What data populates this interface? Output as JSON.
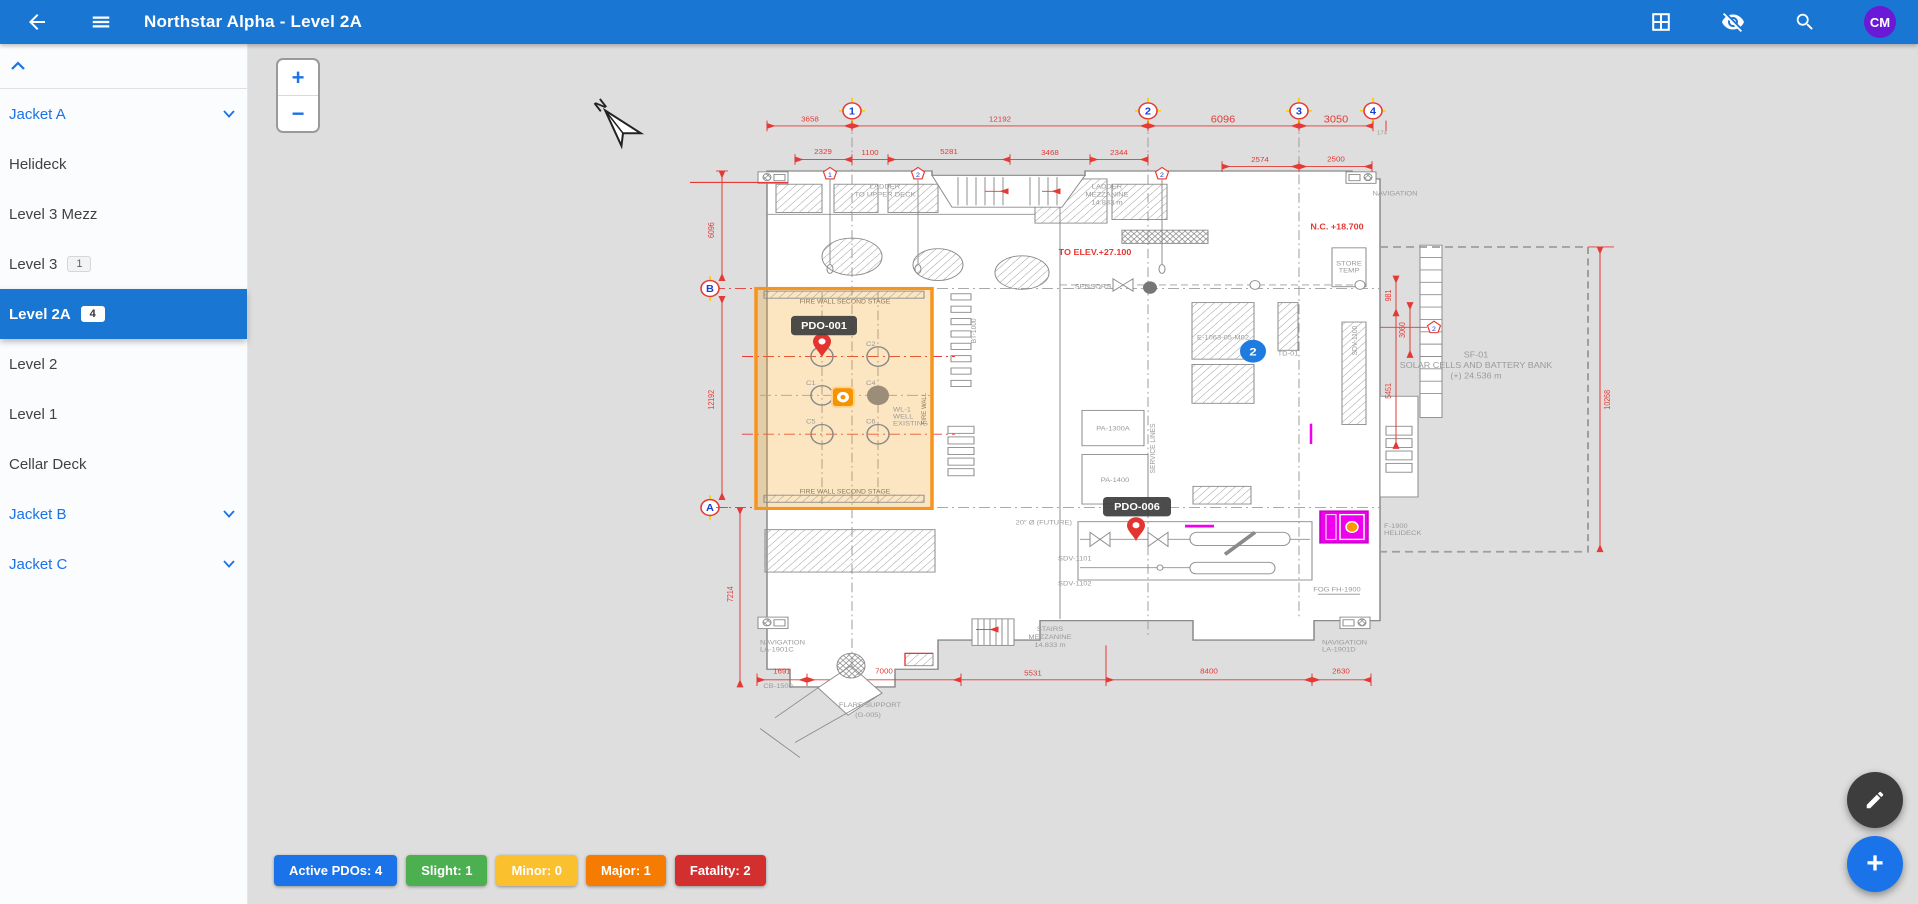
{
  "app_bar": {
    "title": "Northstar Alpha - Level 2A",
    "avatar_initials": "CM"
  },
  "sidebar": {
    "items": [
      {
        "label": "Jacket A",
        "type": "group",
        "expanded": true
      },
      {
        "label": "Helideck"
      },
      {
        "label": "Level 3 Mezz"
      },
      {
        "label": "Level 3",
        "badge": "1"
      },
      {
        "label": "Level 2A",
        "badge": "4",
        "selected": true
      },
      {
        "label": "Level 2"
      },
      {
        "label": "Level 1"
      },
      {
        "label": "Cellar Deck"
      },
      {
        "label": "Jacket B",
        "type": "group",
        "expanded": false
      },
      {
        "label": "Jacket C",
        "type": "group",
        "expanded": false
      }
    ]
  },
  "canvas": {
    "zoom_in": "+",
    "zoom_out": "−",
    "north": "N"
  },
  "markers": {
    "pdo_a": "PDO-001",
    "pdo_b": "PDO-006",
    "cluster_count": "2"
  },
  "plan": {
    "grid_cols": [
      "1",
      "2",
      "3",
      "4"
    ],
    "grid_rows": [
      "B",
      "A"
    ],
    "flags": [
      "1",
      "2",
      "2",
      "2"
    ],
    "dims": {
      "top1": [
        "3658",
        "12192",
        "6096",
        "3050",
        "174"
      ],
      "top2": [
        "2329",
        "1100",
        "5281",
        "3468",
        "2344",
        "2574",
        "2500"
      ],
      "left": [
        "6096",
        "12192",
        "7214"
      ],
      "bottom": [
        "1691",
        "7000",
        "5531",
        "8400",
        "2630"
      ],
      "right": [
        "981",
        "3060",
        "5451",
        "10268"
      ]
    },
    "red_notes": {
      "elev": "TO ELEV.+27.100",
      "nc": "N.C. +18.700"
    },
    "zone": {
      "firewall_top": "FIRE WALL SECOND STAGE",
      "firewall_bottom": "FIRE WALL SECOND STAGE",
      "firewall_side": "FIRE WALL",
      "wells": [
        "C2",
        "C1",
        "C4",
        "C5",
        "C6"
      ],
      "well_label": [
        "WL-1",
        "WELL",
        "EXISTING"
      ]
    },
    "solar": [
      "SF-01",
      "SOLAR CELLS AND BATTERY BANK",
      "(+) 24.536 m"
    ],
    "equipment": {
      "pa1300": "PA-1300A",
      "pa1400": "PA-1400",
      "sdv1101": "SDV-1101",
      "sdv1102": "SDV-1102",
      "e1063": "E-1063-05-M02",
      "td01": "TD-01",
      "sdv1100": "SDV-1100",
      "bt1000": "BT-1000"
    },
    "annotations": {
      "ladder_upper": [
        "LADDER",
        "TO UPPER DECK"
      ],
      "ladder_mezz": [
        "LADDER",
        "MEZZANINE",
        "14.833 m"
      ],
      "nav_top": "NAVIGATION",
      "stairs_mezz": [
        "STAIRS",
        "MEZZANINE",
        "14.833 m"
      ],
      "nav_c": [
        "NAVIGATION",
        "LA-1901C"
      ],
      "nav_d": [
        "NAVIGATION",
        "LA-1901D"
      ],
      "flare": [
        "FLARE SUPPORT",
        "(G-005)"
      ],
      "sensors": "SENSORS",
      "service": "SERVICE LINES",
      "store": [
        "STORE",
        "TEMP"
      ],
      "cb": "CB-1500",
      "fog": "FOG FH-1900",
      "helideck": [
        "F-1900",
        "HELIDECK"
      ],
      "future": "20″ Ø (FUTURE)"
    }
  },
  "status_chips": [
    {
      "label": "Active PDOs: 4",
      "color": "#1a73e8"
    },
    {
      "label": "Slight: 1",
      "color": "#4caf50"
    },
    {
      "label": "Minor: 0",
      "color": "#fbc02d"
    },
    {
      "label": "Major: 1",
      "color": "#f57c00"
    },
    {
      "label": "Fatality: 2",
      "color": "#d32f2f"
    }
  ],
  "fabs": {
    "edit_icon": "pencil",
    "add_icon": "plus"
  },
  "colors": {
    "app_bar": "#1976d2",
    "selected_level": "#1976d2",
    "zone_highlight": "#f7941e",
    "magenta_highlight": "#ee00ee",
    "pin": "#e3342f",
    "cluster": "#1e7be0",
    "avatar": "#6a1ad6"
  }
}
